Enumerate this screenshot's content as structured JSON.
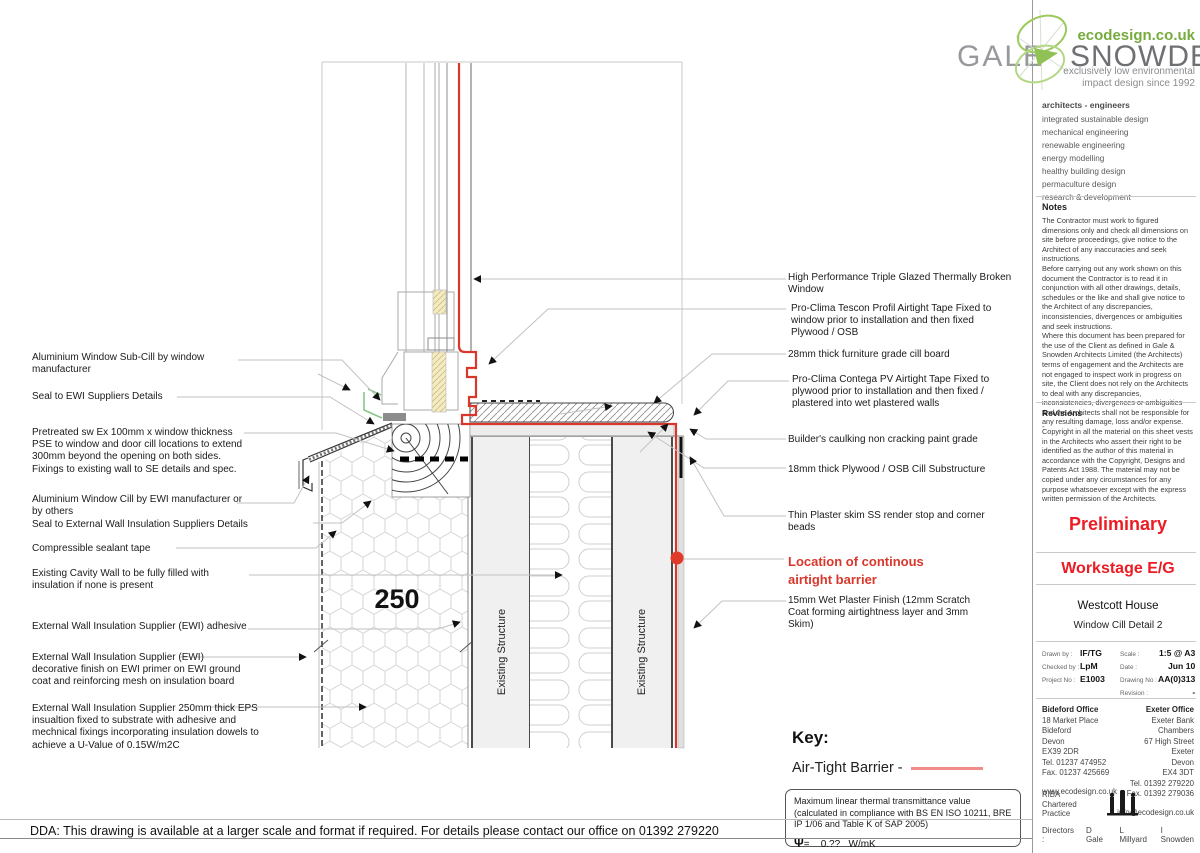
{
  "branding": {
    "name_left": "GALE",
    "name_right": "SNOWDEN",
    "url": "ecodesign.co.uk",
    "tagline1": "exclusively low environmental",
    "tagline2": "impact design since 1992",
    "services_title": "architects  -  engineers",
    "services": [
      "integrated sustainable design",
      "mechanical engineering",
      "renewable engineering",
      "energy modelling",
      "healthy building design",
      "permaculture design",
      "research & development"
    ]
  },
  "notes": {
    "title": "Notes",
    "paragraphs": [
      "The Contractor must work to figured dimensions only and check all dimensions on site before proceedings, give notice to the Architect of any inaccuracies and seek instructions.",
      "Before carrying out any work shown on this document the Contractor is to read it in conjunction with all other drawings, details, schedules or the like and shall give notice to the Architect of any discrepancies, inconsistencies, divergences or ambiguities and seek instructions.",
      "Where this document has been prepared for the use of the Client as defined in Gale & Snowden Architects Limited (the Architects) terms of engagement and the Architects are not engaged to inspect work in progress on site, the Client does not rely on the Architects to deal with any discrepancies, inconsistencies, divergences or ambiguities and the Architects shall not be responsible for any resulting damage, loss and/or expense.",
      "Copyright in all the material on this sheet vests in the Architects who assert their right to be identified as the author of this material in accordance with the Copyright, Designs and Patents Act 1988. The material may not be copied under any circumstances for any purpose whatsoever except with the express written permission of the Architects."
    ]
  },
  "revisions": {
    "title": "Revisions",
    "value": "-"
  },
  "status": {
    "preliminary": "Preliminary",
    "workstage": "Workstage E/G"
  },
  "project": {
    "name": "Westcott House",
    "drawing_title": "Window Cill Detail 2"
  },
  "titleblock": {
    "drawn_by_label": "Drawn by :",
    "drawn_by": "IF/TG",
    "checked_by_label": "Checked by :",
    "checked_by": "LpM",
    "project_no_label": "Project No :",
    "project_no": "E1003",
    "scale_label": "Scale :",
    "scale": "1:5 @ A3",
    "date_label": "Date :",
    "date": "Jun 10",
    "drawing_no_label": "Drawing No :",
    "drawing_no": "AA(0)313",
    "revision_label": "Revision :",
    "revision": "-"
  },
  "offices": {
    "bideford": {
      "title": "Bideford Office",
      "lines": [
        "18 Market Place",
        "Bideford",
        "Devon",
        "EX39 2DR",
        "Tel. 01237 474952",
        "Fax. 01237 425669"
      ],
      "web": "www.ecodesign.co.uk"
    },
    "exeter": {
      "title": "Exeter Office",
      "lines": [
        "Exeter Bank Chambers",
        "67 High Street",
        "Exeter",
        "Devon",
        "EX4 3DT",
        "Tel. 01392 279220",
        "Fax. 01392 279036"
      ],
      "email": "info@ecodesign.co.uk"
    }
  },
  "practice": {
    "riba_lines": [
      "RIBA",
      "Chartered",
      "Practice"
    ],
    "directors_label": "Directors :",
    "directors": [
      "D  Gale",
      "L  Millyard",
      "I  Snowden"
    ]
  },
  "labels_left": [
    {
      "text": "Aluminium Window Sub-Cill by window manufacturer"
    },
    {
      "text": "Seal to EWI Suppliers Details"
    },
    {
      "text": "Pretreated sw Ex 100mm x window thickness PSE to window and door cill locations to extend 300mm beyond the opening on both sides. Fixings to existing wall to SE details and spec."
    },
    {
      "text": "Aluminium Window Cill by EWI manufacturer or by others"
    },
    {
      "text": "Seal to External Wall Insulation Suppliers Details"
    },
    {
      "text": "Compressible sealant tape"
    },
    {
      "text": "Existing Cavity Wall to be fully filled with insulation if none is present"
    },
    {
      "text": "External Wall Insulation Supplier (EWI) adhesive"
    },
    {
      "text": "External Wall Insulation Supplier (EWI) decorative finish on EWI primer on EWI ground coat and reinforcing mesh on insulation board"
    },
    {
      "text": "External Wall Insulation Supplier 250mm thick EPS insualtion fixed to substrate with adhesive and mechnical fixings incorporating insulation dowels to achieve a U-Value of 0.15W/m2C"
    }
  ],
  "labels_right": [
    {
      "text": "High Performance Triple Glazed Thermally Broken Window"
    },
    {
      "text": "Pro-Clima Tescon Profil Airtight Tape Fixed to window prior to installation and then fixed Plywood / OSB"
    },
    {
      "text": "28mm thick furniture grade cill board"
    },
    {
      "text": "Pro-Clima Contega PV Airtight Tape Fixed to plywood prior to installation and then fixed / plastered into wet plastered walls"
    },
    {
      "text": "Builder's caulking non cracking paint grade"
    },
    {
      "text": "18mm thick Plywood / OSB Cill Substructure"
    },
    {
      "text": "Thin Plaster skim SS render stop and corner beads"
    },
    {
      "text": "Location of continous airtight barrier"
    },
    {
      "text": "15mm Wet Plaster Finish (12mm Scratch Coat forming airtightness layer and 3mm Skim)"
    }
  ],
  "drawing": {
    "dimension": "250",
    "structure_label": "Existing Structure",
    "airtight_red": "#d9372c",
    "key_pink": "#ef8d86"
  },
  "key": {
    "title": "Key:",
    "airtight_label": "Air-Tight Barrier -",
    "psi_note": "Maximum linear thermal transmittance value (calculated in compliance with BS EN ISO 10211, BRE IP 1/06 and  Table K of SAP 2005)",
    "psi_symbol": "Ψ",
    "psi_eq": "=",
    "psi_value": "0.??",
    "psi_unit": "W/mK"
  },
  "footer": {
    "dda": "DDA: This drawing is available at a larger scale and format if required. For details please contact our office on 01392 279220"
  }
}
